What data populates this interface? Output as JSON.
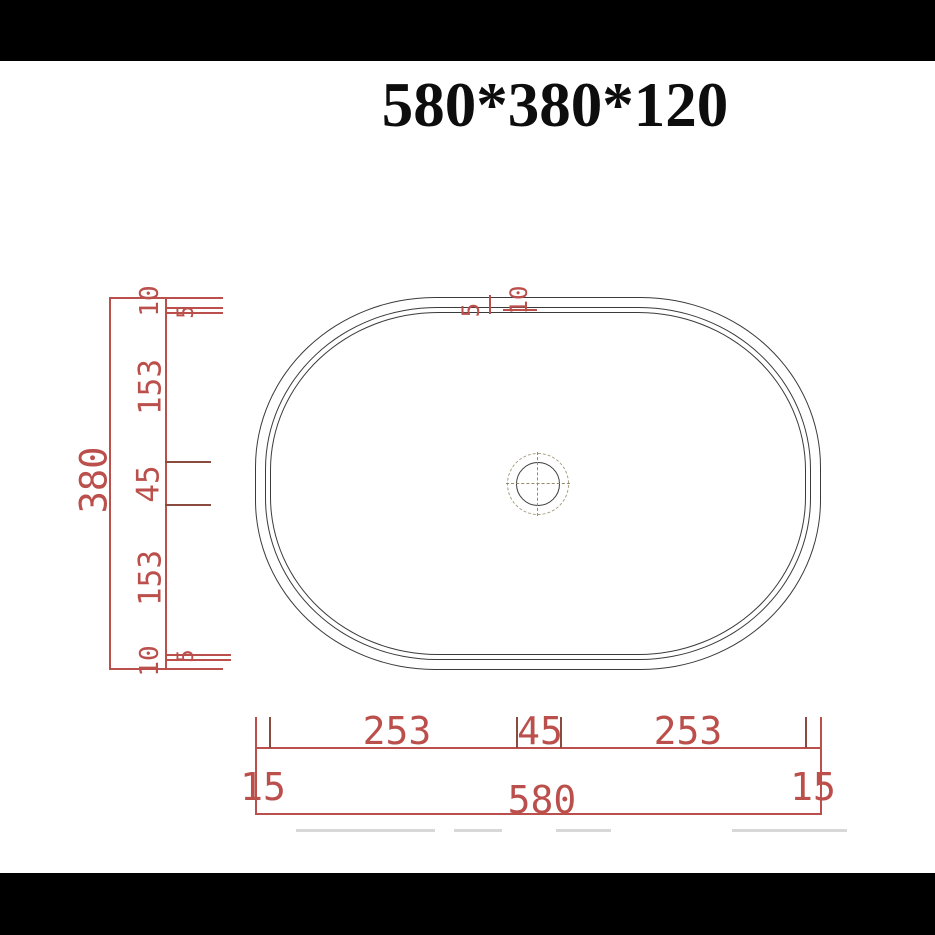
{
  "title": "580*380*120",
  "colors": {
    "dimension_red": "#bb4f4b",
    "dimension_dark_red": "#8a4a3e",
    "outline_gray": "#3b3b3b",
    "centerline_olive": "#958c6e",
    "letterbox_black": "#000000",
    "background": "#ffffff"
  },
  "vertical_dimensions": {
    "overall": "380",
    "segments": [
      "10",
      "5",
      "153",
      "45",
      "153",
      "5",
      "10"
    ]
  },
  "top_rim_dimensions": {
    "segments": [
      "5",
      "10"
    ]
  },
  "horizontal_dimensions": {
    "overall": "580",
    "left_offset": "15",
    "right_offset": "15",
    "segments": [
      "253",
      "45",
      "253"
    ]
  }
}
